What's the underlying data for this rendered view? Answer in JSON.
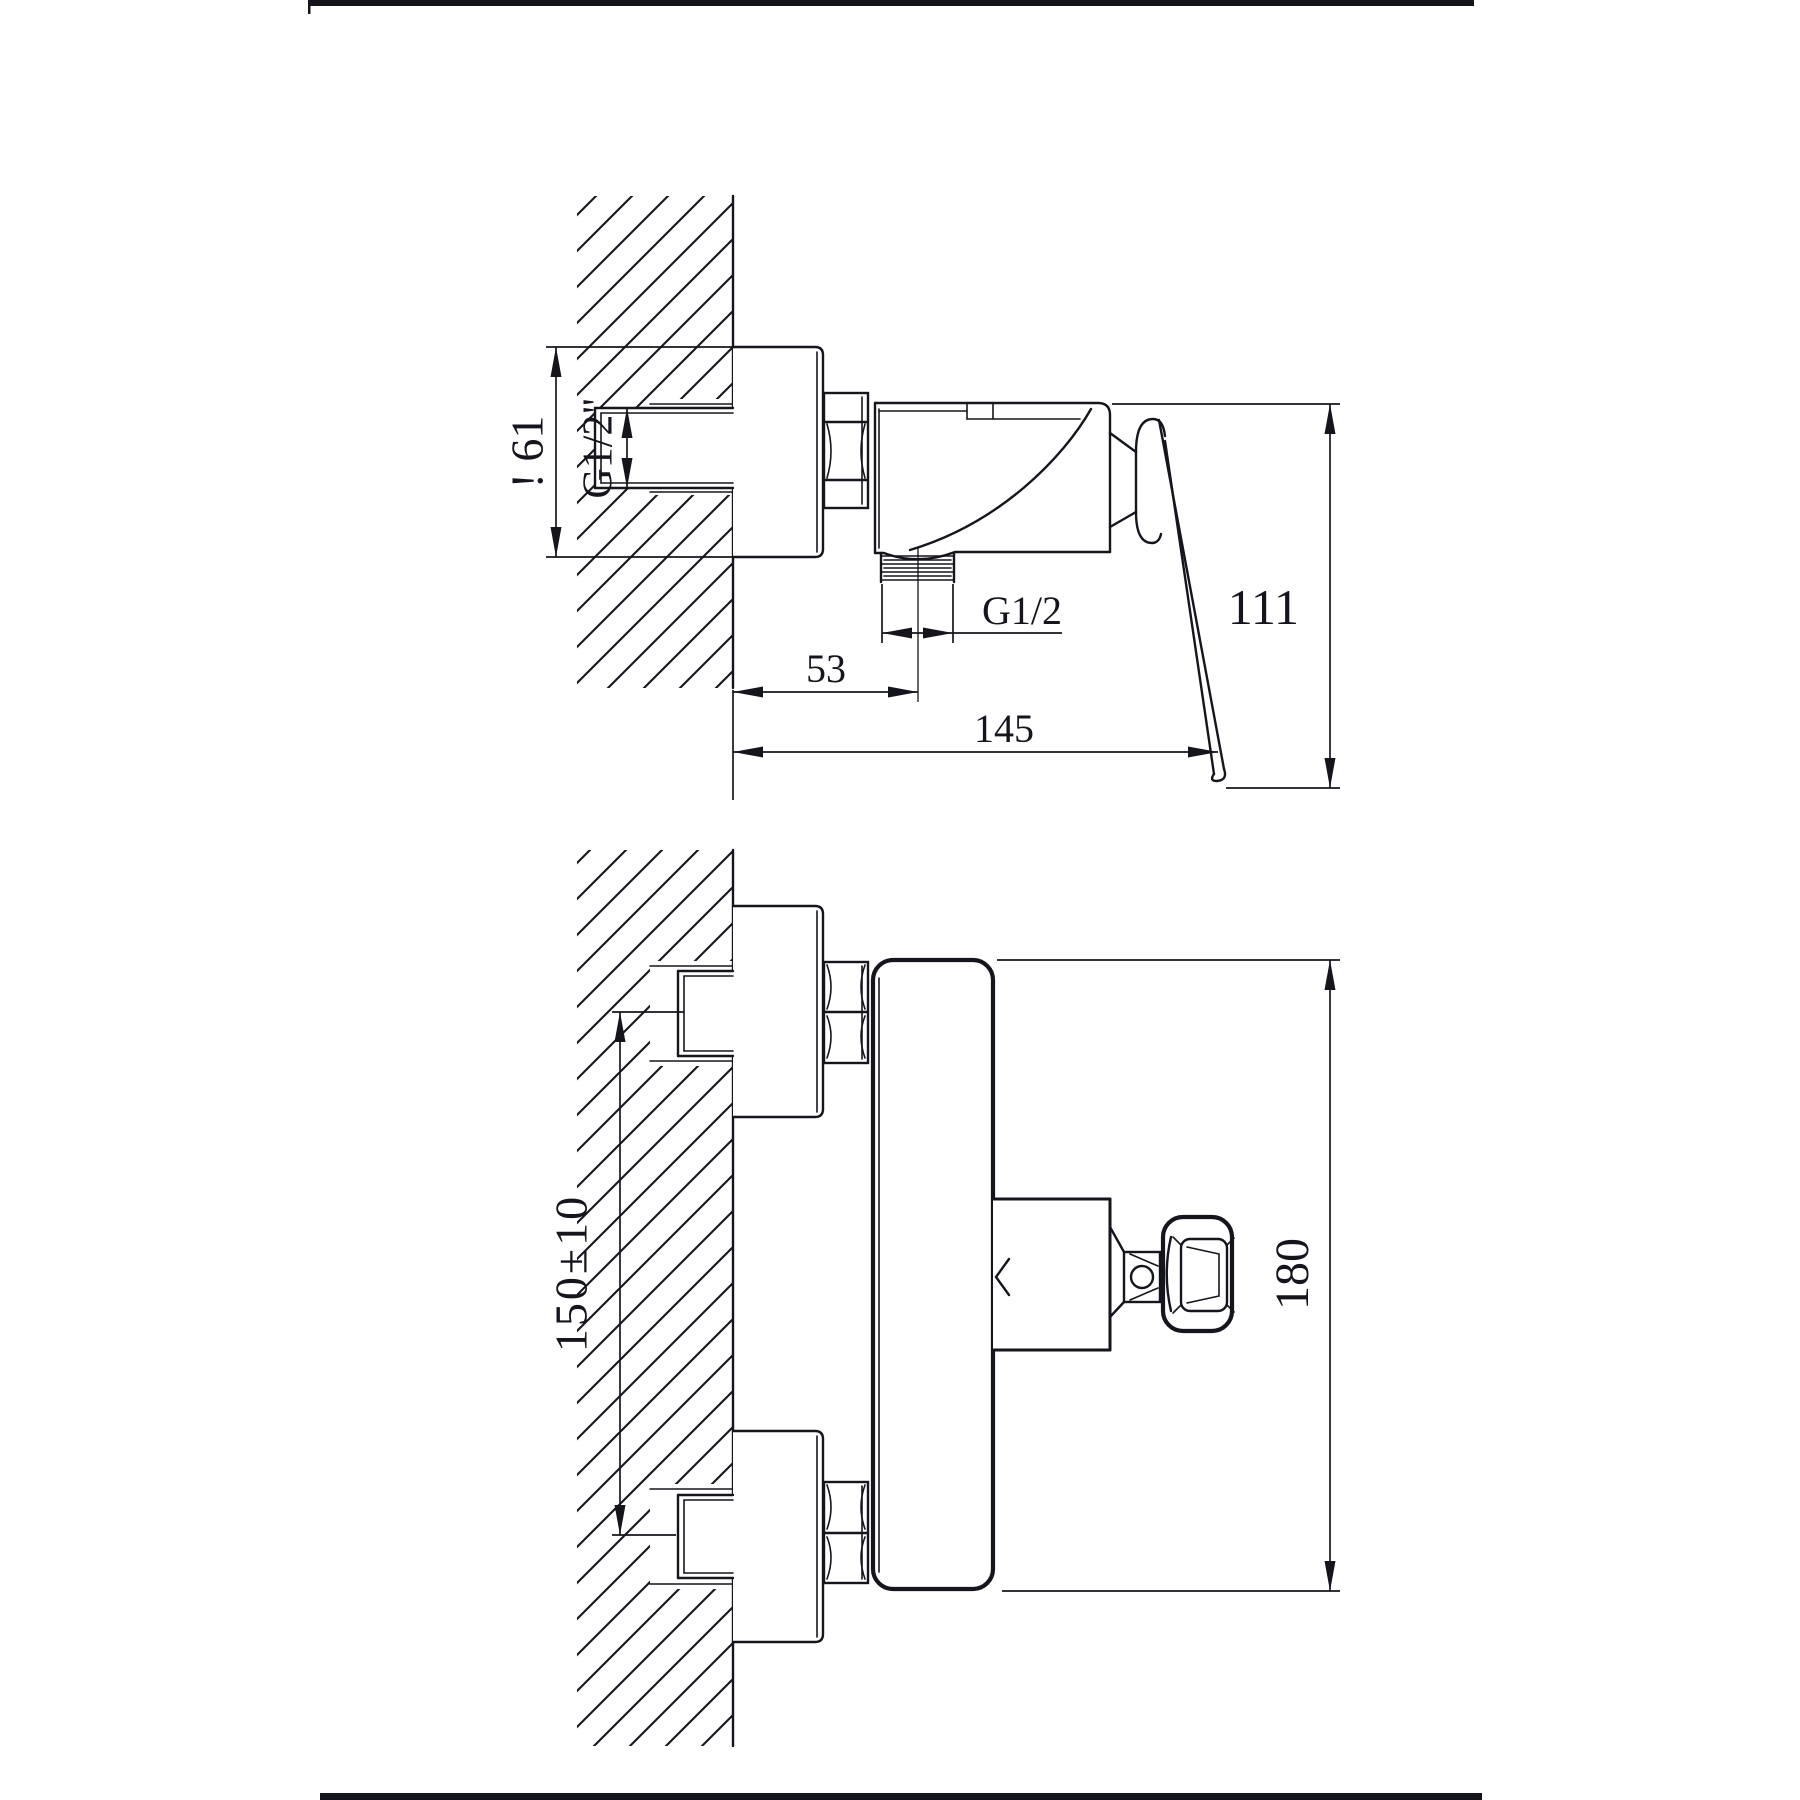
{
  "drawing": {
    "type": "technical-drawing",
    "subject": "wall-mounted shower mixer faucet, two orthographic views",
    "line_color": "#15151d",
    "background": "#ffffff"
  },
  "labels": {
    "d61": "! 61",
    "g12_inlet": "G1/2\"",
    "g12_outlet": "G1/2",
    "d53": "53",
    "d145": "145",
    "d111": "111",
    "d150": "150±10",
    "d180": "180"
  }
}
